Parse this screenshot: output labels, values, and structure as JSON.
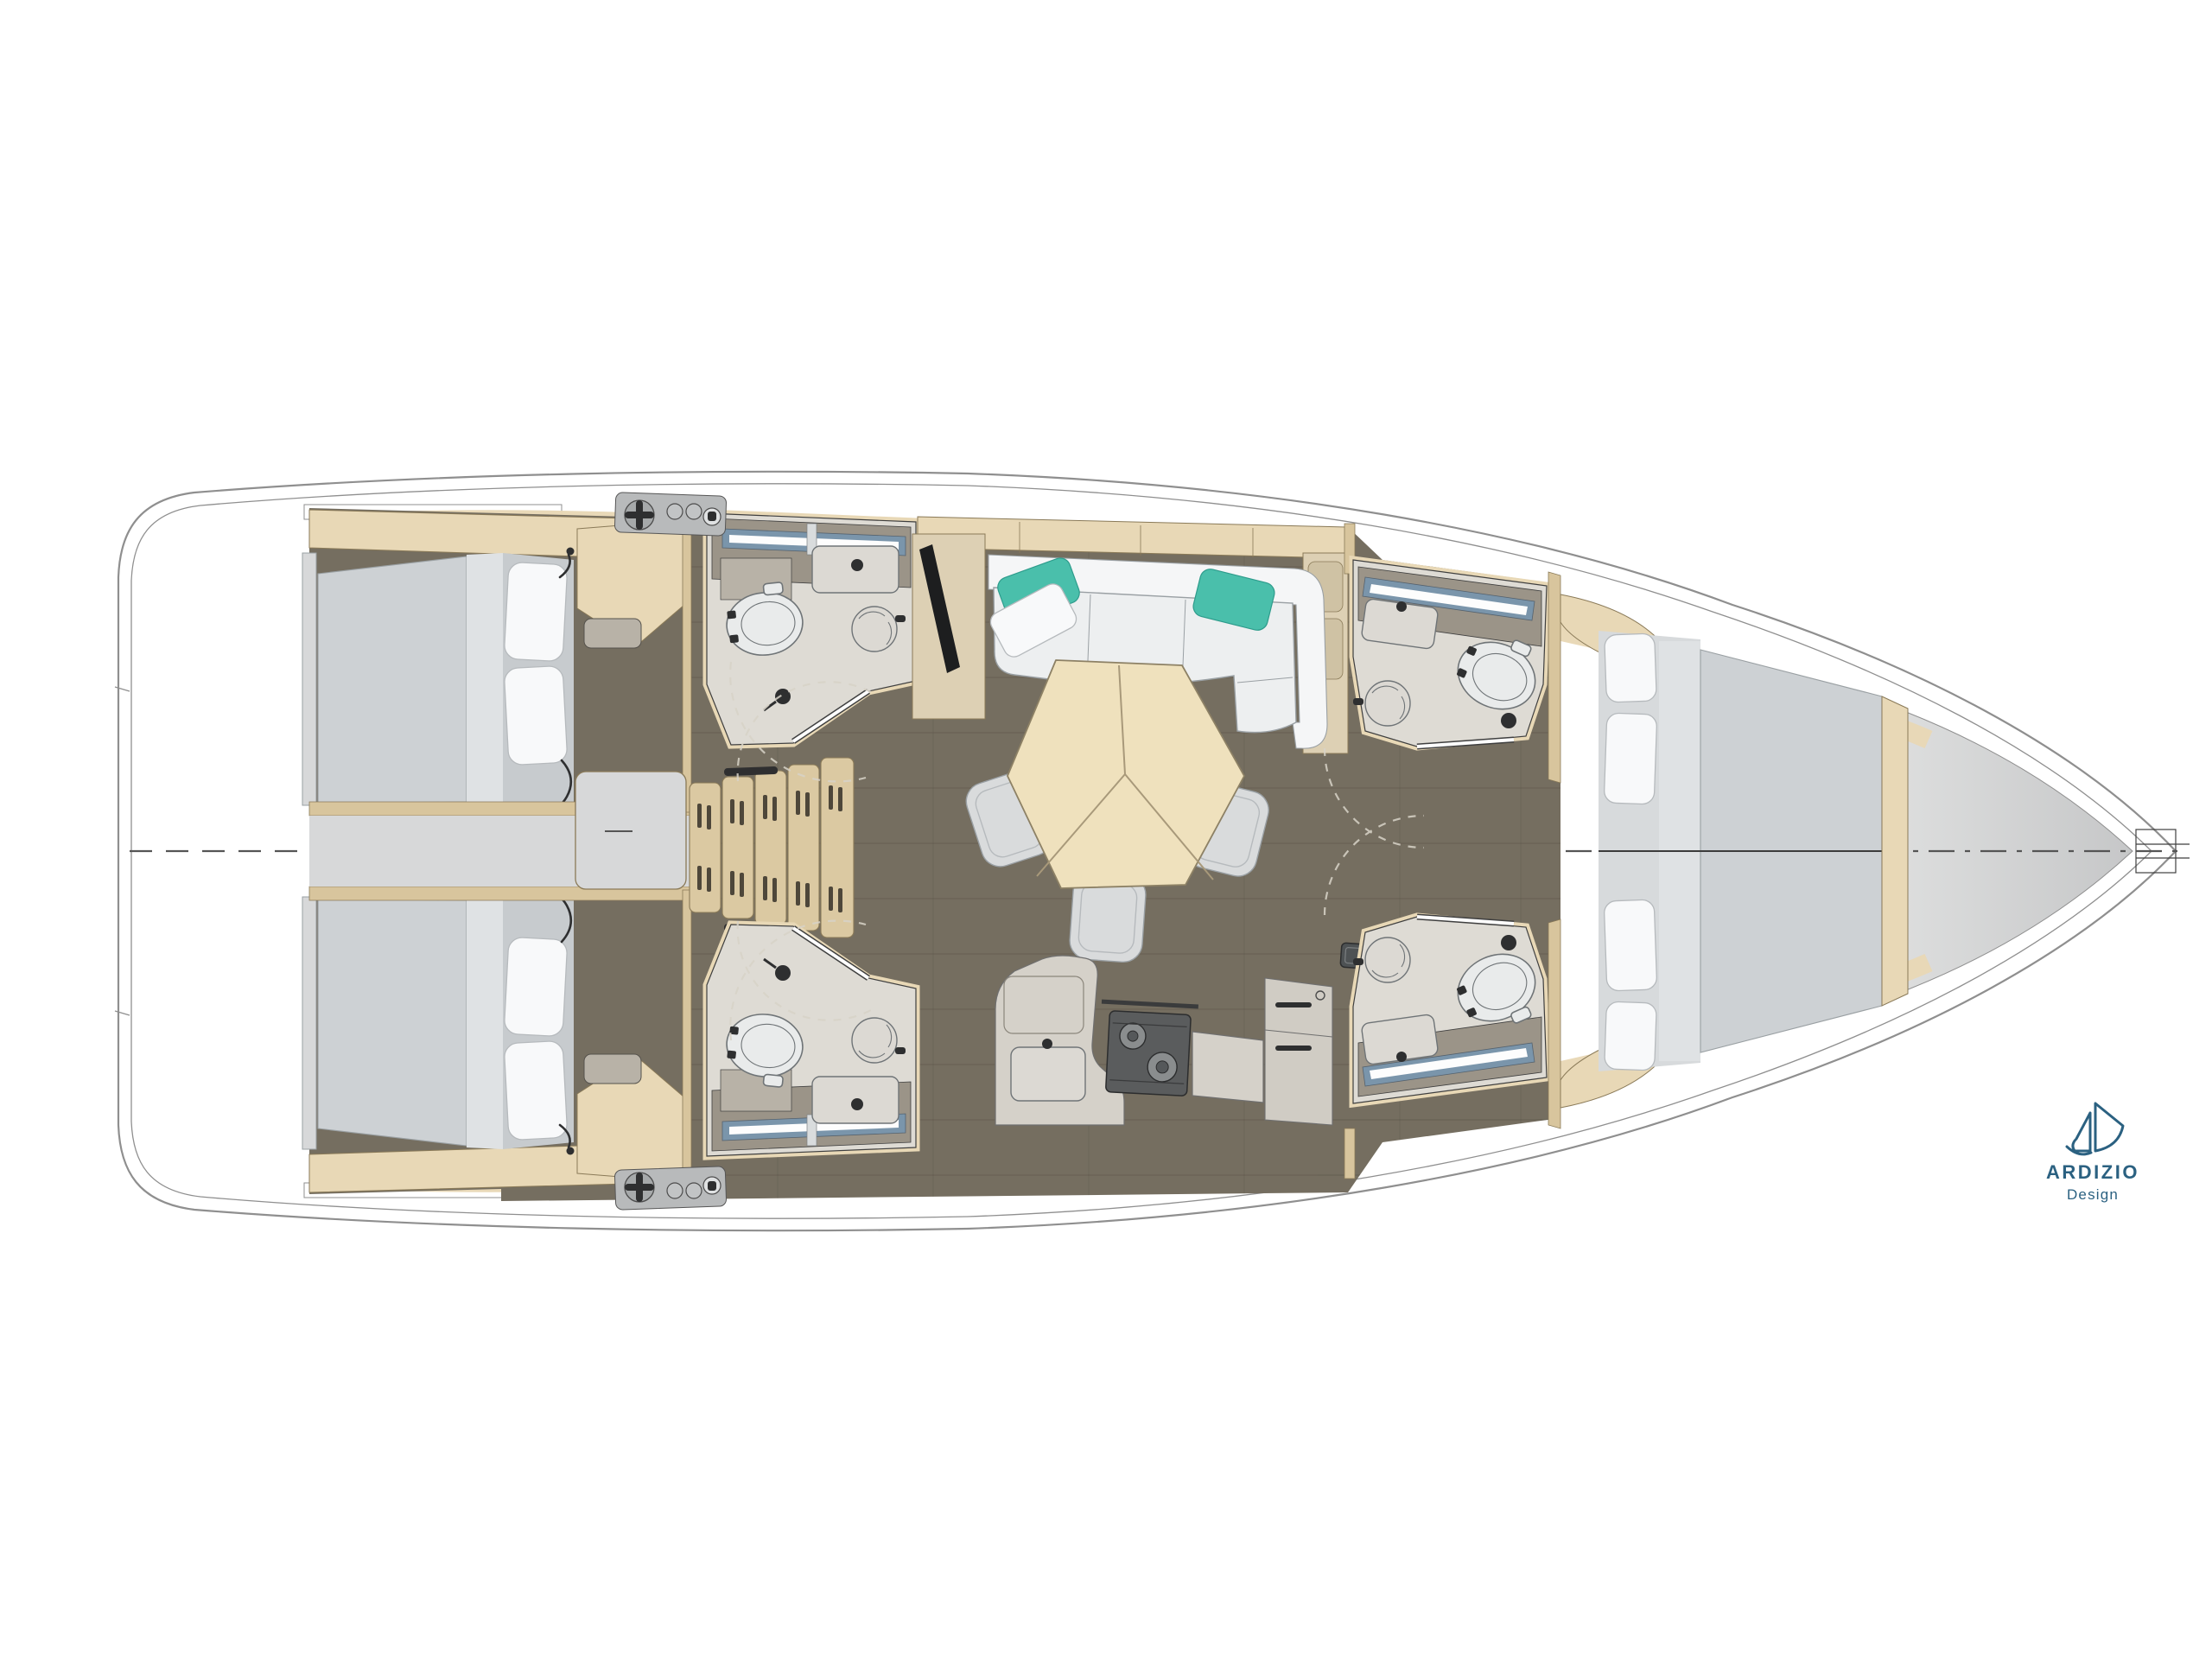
{
  "logo": {
    "brand": "ARDIZIO",
    "subtitle": "Design",
    "icon": "sailboat-icon"
  },
  "colors": {
    "hull-line": "#8f8f8f",
    "outline": "#3f3f3f",
    "deck-gray-1": "#dcdddd",
    "deck-gray-2": "#c6c7c8",
    "floor-wood": "#756e60",
    "floor-seam": "#4e483c",
    "trim": "#e8d8b6",
    "trim-dark": "#d8c59d",
    "trim-stroke": "#8a7a58",
    "table-wood": "#efe1bd",
    "table-stroke": "#8d8165",
    "table-seam": "#a8997a",
    "stairs-wood": "#dbc9a2",
    "stair-slot": "#4e473a",
    "mattress": "#cdd1d4",
    "mattress-light": "#dfe2e4",
    "mattress-pillowzone": "#c7cbce",
    "matt-stroke": "#9aa0a3",
    "pillow": "#f8f9fa",
    "pillow-stroke": "#b6babd",
    "sofa": "#edeff0",
    "sofa-back": "#f5f6f7",
    "sofa-stroke": "#9aa0a4",
    "teal": "#4abfab",
    "teal-stroke": "#2e9c8c",
    "stool": "#d9dbdc",
    "gray-box": "#d7d8d9",
    "bath-floor": "#dedbd4",
    "bath-counter": "#9b9488",
    "basin": "#dcd9d3",
    "fixture": "#e9ebeb",
    "fixture-stroke": "#6f7477",
    "mirror-blue": "#7a95ab",
    "shelf-gray": "#b8b2a7",
    "hw-dark": "#2e2f30",
    "hob": "#5a5c5d",
    "burner": "#8a8d8e",
    "panel-gray": "#b8babb",
    "counter-top": "#d5d1c9",
    "fridge": "#d0ccc4",
    "cab-wood": "#ddd0b4",
    "tv-black": "#1d1e1f",
    "centerline": "#555555",
    "arc": "#d8d3c8",
    "logo": "#2b6181"
  }
}
